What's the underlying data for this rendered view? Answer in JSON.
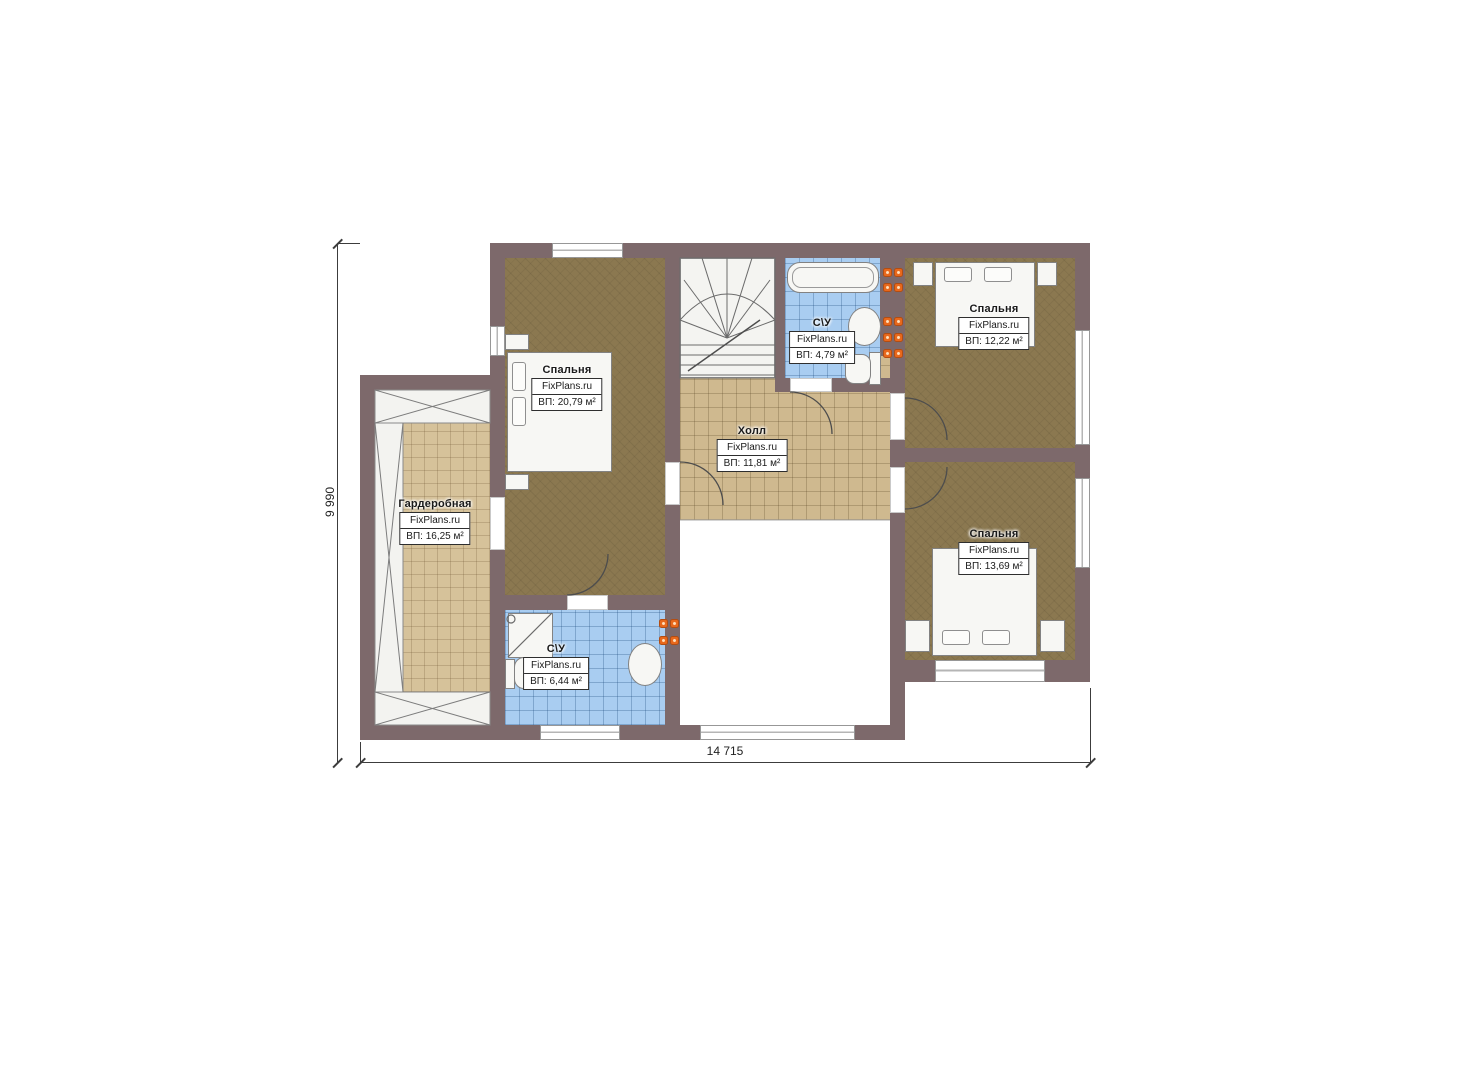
{
  "plan": {
    "type": "floor-plan",
    "rooms": {
      "bedroom1": {
        "name": "Спальня",
        "brand": "FixPlans.ru",
        "area": "ВП: 20,79 м²"
      },
      "wardrobe": {
        "name": "Гардеробная",
        "brand": "FixPlans.ru",
        "area": "ВП: 16,25 м²"
      },
      "hall": {
        "name": "Холл",
        "brand": "FixPlans.ru",
        "area": "ВП: 11,81 м²"
      },
      "bath_top": {
        "name": "С\\У",
        "brand": "FixPlans.ru",
        "area": "ВП: 4,79 м²"
      },
      "bedroom2": {
        "name": "Спальня",
        "brand": "FixPlans.ru",
        "area": "ВП: 12,22 м²"
      },
      "bedroom3": {
        "name": "Спальня",
        "brand": "FixPlans.ru",
        "area": "ВП: 13,69 м²"
      },
      "bath_bottom": {
        "name": "С\\У",
        "brand": "FixPlans.ru",
        "area": "ВП: 6,44 м²"
      }
    },
    "dimensions": {
      "width_label": "14 715",
      "height_label": "9 990"
    },
    "icons": [
      "bed-icon",
      "bathtub-icon",
      "sink-icon",
      "toilet-icon",
      "shower-icon",
      "stairs-icon",
      "radiator-icon",
      "wardrobe-storage-icon",
      "door-arc-icon",
      "window-icon"
    ],
    "colors": {
      "wall": "#7d696b",
      "bedroom_floor": "#8b7850",
      "tile_tan": "#cfb98f",
      "tile_blue": "#a9cdf1",
      "radiator": "#e8681c"
    }
  }
}
